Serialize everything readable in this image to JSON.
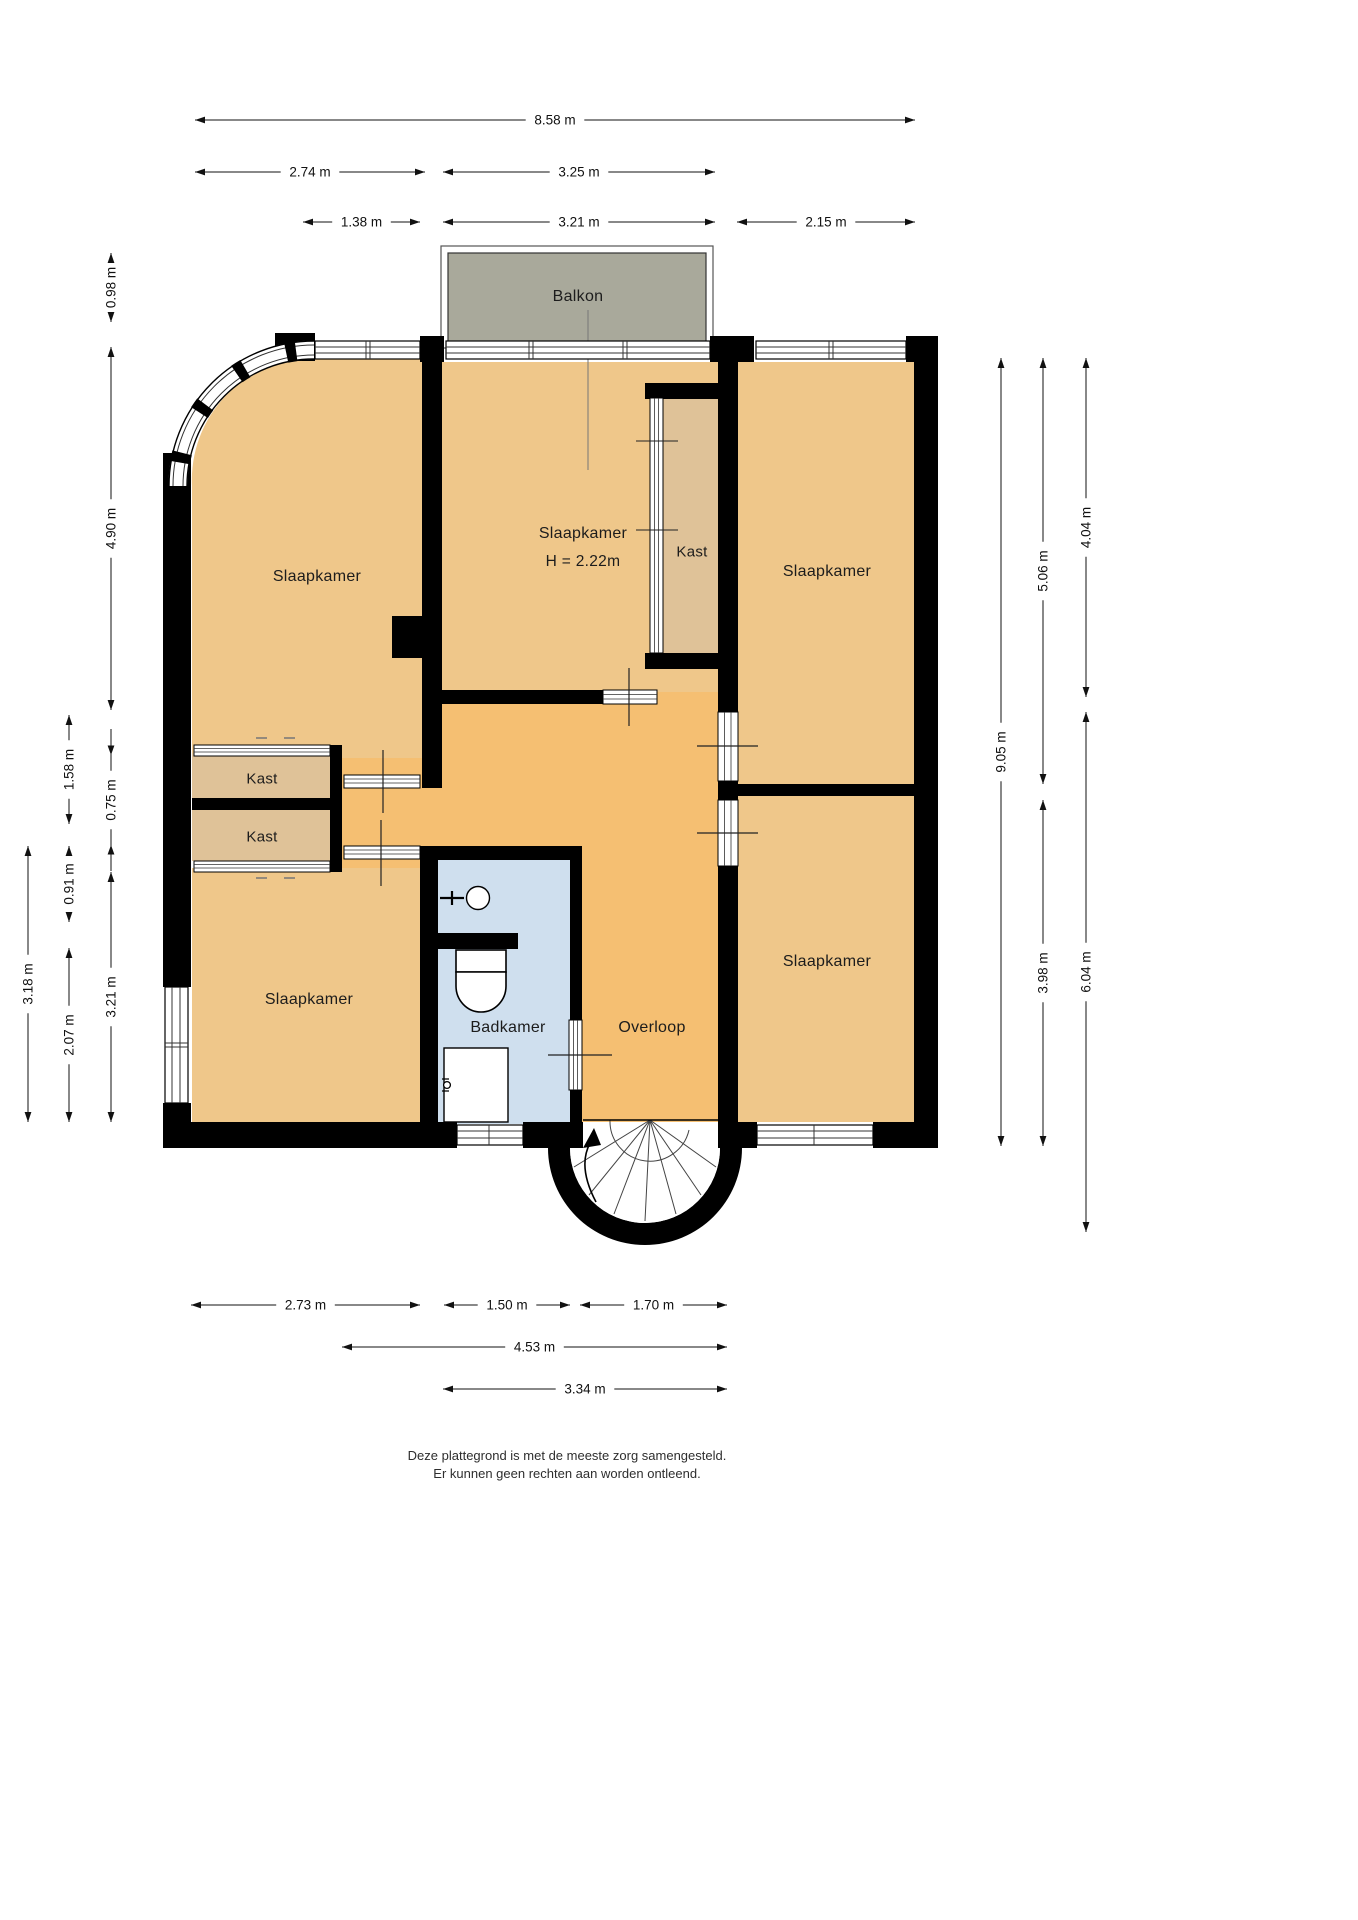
{
  "title": "Plattegrond verdieping",
  "colors": {
    "bedroom_tan": "#efc78a",
    "hall_orange": "#f5bf72",
    "closet_tan": "#dfc298",
    "balcony_gray": "#a9a99b",
    "bathroom_blue": "#cfdfee",
    "wall_black": "#000000",
    "glazing_line": "#333333",
    "dim_color": "#111111"
  },
  "rooms": [
    {
      "id": "balkon",
      "label": "Balkon",
      "x": 578,
      "y": 297,
      "size": 16
    },
    {
      "id": "slaapkamer-top-left",
      "label": "Slaapkamer",
      "x": 317,
      "y": 577,
      "size": 16
    },
    {
      "id": "slaapkamer-middle",
      "label": "Slaapkamer",
      "x": 583,
      "y": 534,
      "size": 16
    },
    {
      "id": "ceiling-height",
      "label": "H = 2.22m",
      "x": 583,
      "y": 562,
      "size": 15.5
    },
    {
      "id": "kast-middle",
      "label": "Kast",
      "x": 692,
      "y": 552,
      "size": 15
    },
    {
      "id": "slaapkamer-top-right",
      "label": "Slaapkamer",
      "x": 827,
      "y": 572,
      "size": 16
    },
    {
      "id": "kast-1",
      "label": "Kast",
      "x": 262,
      "y": 779,
      "size": 15
    },
    {
      "id": "kast-2",
      "label": "Kast",
      "x": 262,
      "y": 837,
      "size": 15
    },
    {
      "id": "slaapkamer-bottom-left",
      "label": "Slaapkamer",
      "x": 309,
      "y": 1000,
      "size": 16
    },
    {
      "id": "badkamer",
      "label": "Badkamer",
      "x": 508,
      "y": 1028,
      "size": 16
    },
    {
      "id": "overloop",
      "label": "Overloop",
      "x": 652,
      "y": 1028,
      "size": 16
    },
    {
      "id": "slaapkamer-bottom-right",
      "label": "Slaapkamer",
      "x": 827,
      "y": 962,
      "size": 16
    }
  ],
  "dimensions": {
    "top": [
      {
        "label": "8.58 m",
        "x1": 195,
        "x2": 915,
        "y": 120
      },
      {
        "label": "2.74 m",
        "x1": 195,
        "x2": 425,
        "y": 172
      },
      {
        "label": "3.25 m",
        "x1": 443,
        "x2": 715,
        "y": 172
      },
      {
        "label": "1.38 m",
        "x1": 303,
        "x2": 420,
        "y": 222
      },
      {
        "label": "3.21 m",
        "x1": 443,
        "x2": 715,
        "y": 222
      },
      {
        "label": "2.15 m",
        "x1": 737,
        "x2": 915,
        "y": 222
      }
    ],
    "bottom": [
      {
        "label": "2.73 m",
        "x1": 191,
        "x2": 420,
        "y": 1305
      },
      {
        "label": "1.50 m",
        "x1": 444,
        "x2": 570,
        "y": 1305
      },
      {
        "label": "1.70 m",
        "x1": 580,
        "x2": 727,
        "y": 1305
      },
      {
        "label": "4.53 m",
        "x1": 342,
        "x2": 727,
        "y": 1347
      },
      {
        "label": "3.34 m",
        "x1": 443,
        "x2": 727,
        "y": 1389
      }
    ],
    "left": [
      {
        "label": "0.98 m",
        "x": 111,
        "y1": 253,
        "y2": 322,
        "style": "normal"
      },
      {
        "label": "4.90 m",
        "x": 111,
        "y1": 347,
        "y2": 710,
        "style": "normal"
      },
      {
        "label": "1.58 m",
        "x": 69,
        "y1": 715,
        "y2": 824,
        "style": "normal"
      },
      {
        "label": "0.75 m",
        "x": 111,
        "y1": 755,
        "y2": 845,
        "style": "inward"
      },
      {
        "label": "0.91 m",
        "x": 69,
        "y1": 846,
        "y2": 922,
        "style": "normal"
      },
      {
        "label": "3.18 m",
        "x": 28,
        "y1": 846,
        "y2": 1122,
        "style": "normal"
      },
      {
        "label": "3.21 m",
        "x": 111,
        "y1": 872,
        "y2": 1122,
        "style": "normal"
      },
      {
        "label": "2.07 m",
        "x": 69,
        "y1": 948,
        "y2": 1122,
        "style": "normal"
      }
    ],
    "right": [
      {
        "label": "4.04 m",
        "x": 1086,
        "y1": 358,
        "y2": 697,
        "style": "normal"
      },
      {
        "label": "5.06 m",
        "x": 1043,
        "y1": 358,
        "y2": 784,
        "style": "normal"
      },
      {
        "label": "9.05 m",
        "x": 1001,
        "y1": 358,
        "y2": 1146,
        "style": "normal"
      },
      {
        "label": "3.98 m",
        "x": 1043,
        "y1": 800,
        "y2": 1146,
        "style": "normal"
      },
      {
        "label": "6.04 m",
        "x": 1086,
        "y1": 712,
        "y2": 1232,
        "style": "normal"
      }
    ]
  },
  "footer": {
    "line1": "Deze plattegrond is met de meeste zorg samengesteld.",
    "line2": "Er kunnen geen rechten aan worden ontleend.",
    "x": 567,
    "y": 1447
  }
}
